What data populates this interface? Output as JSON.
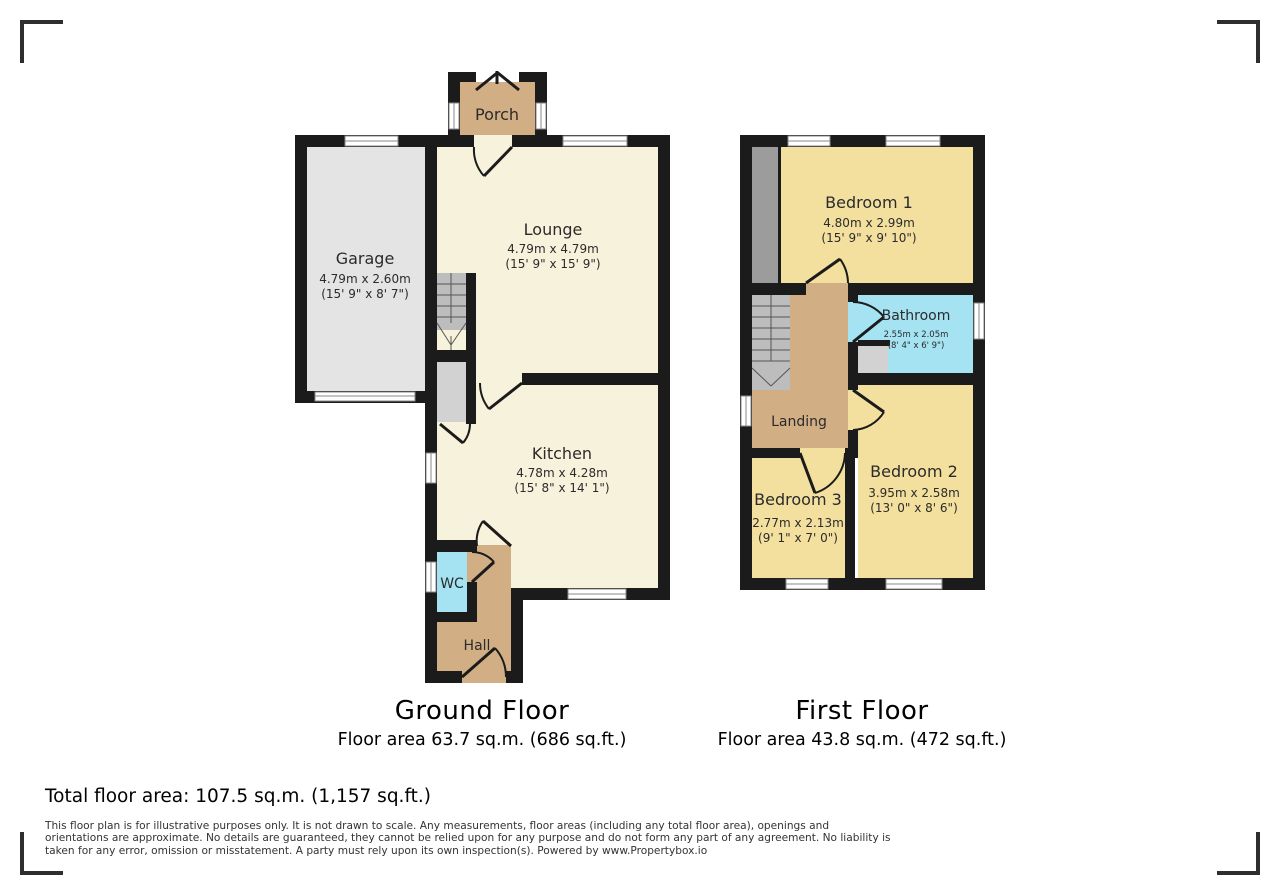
{
  "ground_floor": {
    "caption_title": "Ground Floor",
    "caption_area": "Floor area 63.7 sq.m. (686 sq.ft.)",
    "rooms": {
      "porch": {
        "label": "Porch"
      },
      "garage": {
        "label": "Garage",
        "dims_metric": "4.79m x 2.60m",
        "dims_imperial": "(15' 9\" x 8' 7\")"
      },
      "lounge": {
        "label": "Lounge",
        "dims_metric": "4.79m x 4.79m",
        "dims_imperial": "(15' 9\" x 15' 9\")"
      },
      "kitchen": {
        "label": "Kitchen",
        "dims_metric": "4.78m x 4.28m",
        "dims_imperial": "(15' 8\" x 14' 1\")"
      },
      "wc": {
        "label": "WC"
      },
      "hall": {
        "label": "Hall"
      }
    }
  },
  "first_floor": {
    "caption_title": "First Floor",
    "caption_area": "Floor area 43.8 sq.m. (472 sq.ft.)",
    "rooms": {
      "bedroom1": {
        "label": "Bedroom 1",
        "dims_metric": "4.80m x 2.99m",
        "dims_imperial": "(15' 9\" x 9' 10\")"
      },
      "bathroom": {
        "label": "Bathroom",
        "dims_metric": "2.55m x 2.05m",
        "dims_imperial": "(8' 4\" x 6' 9\")"
      },
      "landing": {
        "label": "Landing"
      },
      "bedroom2": {
        "label": "Bedroom 2",
        "dims_metric": "3.95m x 2.58m",
        "dims_imperial": "(13' 0\" x 8' 6\")"
      },
      "bedroom3": {
        "label": "Bedroom 3",
        "dims_metric": "2.77m x 2.13m",
        "dims_imperial": "(9' 1\" x 7' 0\")"
      }
    }
  },
  "summary": {
    "total_area": "Total floor area: 107.5 sq.m. (1,157 sq.ft.)"
  },
  "disclaimer": "This floor plan is for illustrative purposes only. It is not drawn to scale. Any measurements, floor areas (including any total floor area), openings and orientations are approximate. No details are guaranteed, they cannot be relied upon for any purpose and do not form any part of any agreement. No liability is taken for any error, omission or misstatement. A party must rely upon its own inspection(s). Powered by www.Propertybox.io",
  "colors": {
    "wall": "#1b1b1b",
    "room_cream": "#f7f2dc",
    "room_yellow": "#f3e09f",
    "room_cyan": "#a5e3f2",
    "room_tan": "#d2ae85",
    "garage_gray": "#e4e4e4",
    "stairs_gray": "#bdbdbd",
    "cupboard_gray": "#d2d2d2",
    "wardrobe_gray": "#9c9c9c"
  }
}
